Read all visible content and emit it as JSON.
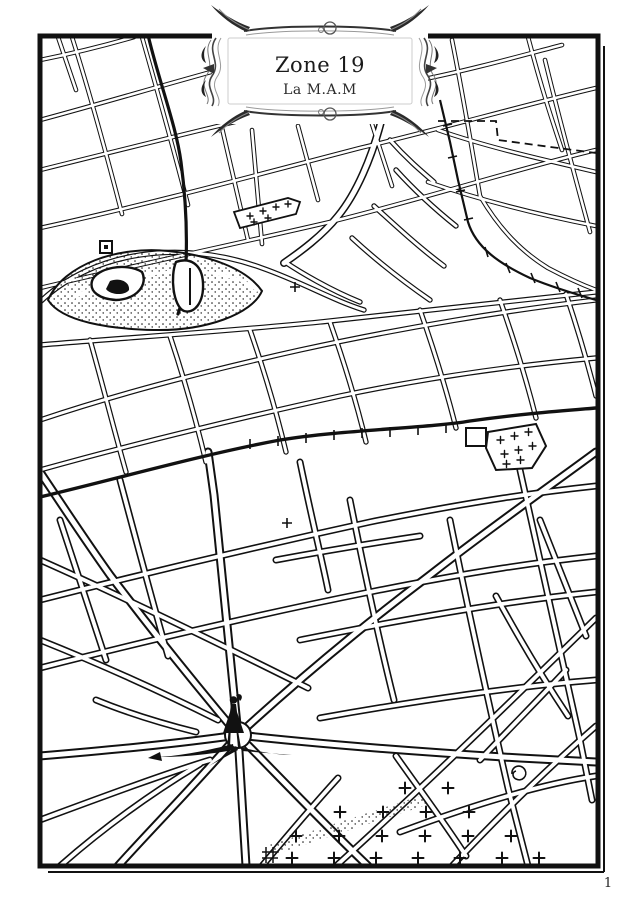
{
  "cartouche": {
    "title": "Zone 19",
    "subtitle": "La M.A.M"
  },
  "footer": {
    "page_number": "1"
  },
  "colors": {
    "ink": "#111111",
    "paper": "#ffffff",
    "ornament_grey": "#555555"
  },
  "map": {
    "symbol_names": [
      "figure-marker-icon",
      "figure-shadow-icon",
      "cemetery-cross-icon",
      "church-cross-icon",
      "railway-tick-line",
      "dashed-zone-boundary",
      "route-line",
      "park-stipple-area",
      "pond",
      "spiral-marker-icon",
      "square-marker-icon"
    ]
  }
}
